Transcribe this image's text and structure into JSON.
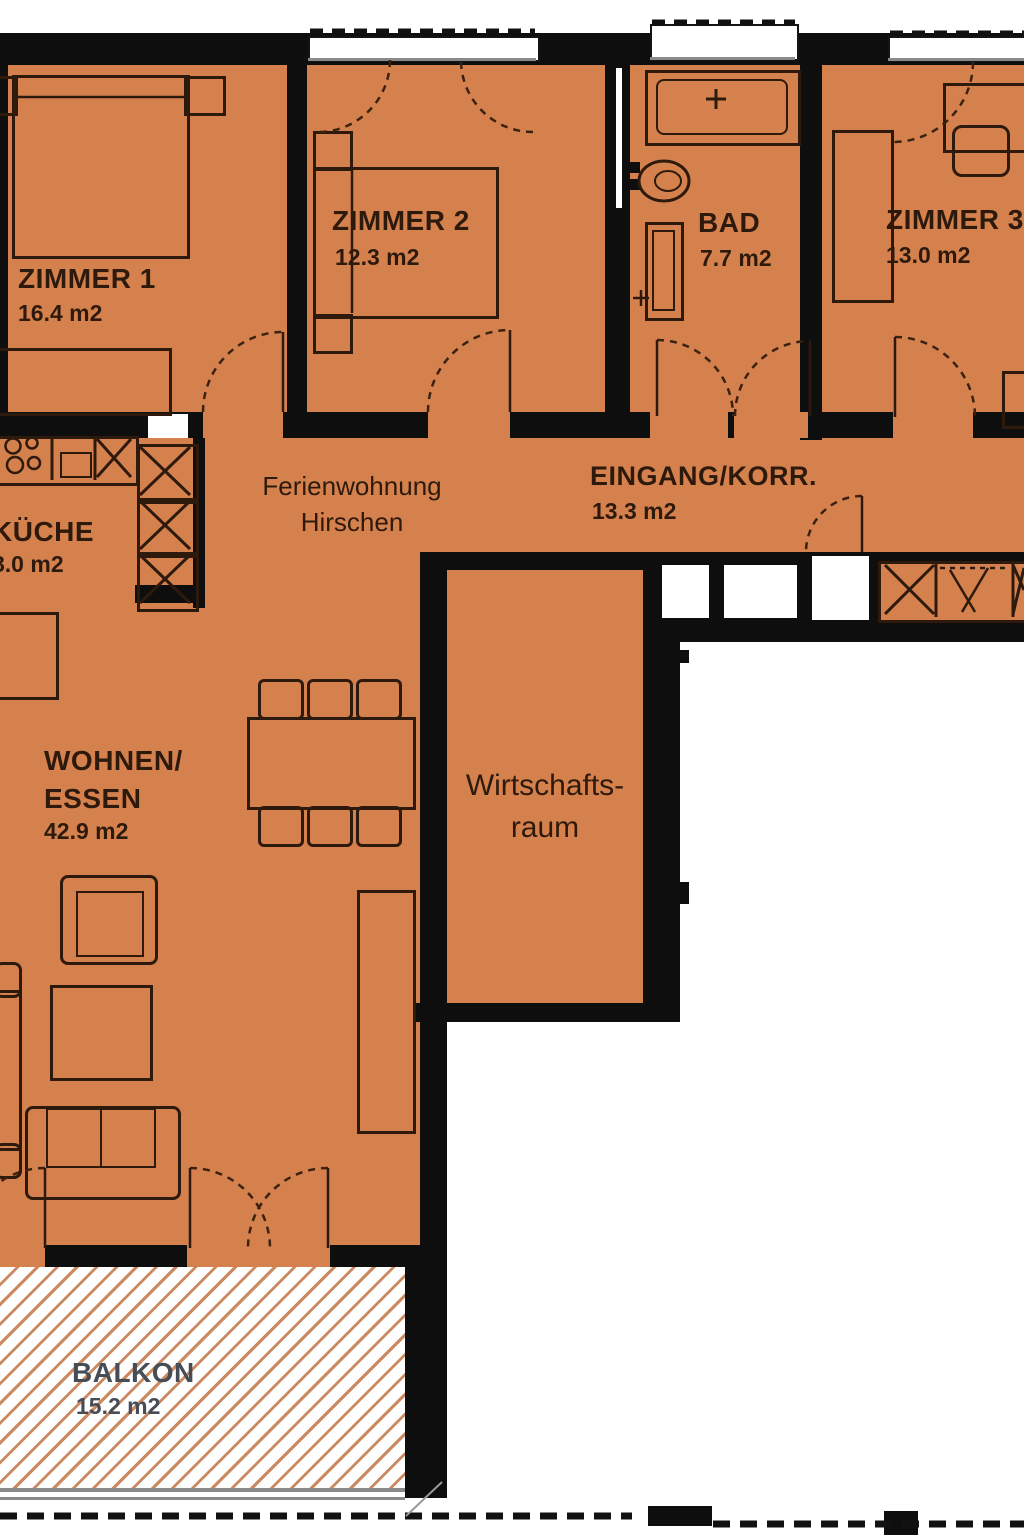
{
  "floorplan": {
    "title": {
      "line1": "Ferienwohnung",
      "line2": "Hirschen"
    },
    "rooms": {
      "zimmer1": {
        "name": "ZIMMER 1",
        "area": "16.4 m2"
      },
      "zimmer2": {
        "name": "ZIMMER 2",
        "area": "12.3 m2"
      },
      "bad": {
        "name": "BAD",
        "area": "7.7 m2"
      },
      "zimmer3": {
        "name": "ZIMMER 3",
        "area": "13.0 m2"
      },
      "kueche": {
        "name": "KÜCHE",
        "area": "8.0 m2"
      },
      "eingang": {
        "name": "EINGANG/KORR.",
        "area": "13.3 m2"
      },
      "wohnen": {
        "name_line1": "WOHNEN/",
        "name_line2": "ESSEN",
        "area": "42.9 m2"
      },
      "wirtschaftsraum": {
        "name_line1": "Wirtschafts-",
        "name_line2": "raum"
      },
      "balkon": {
        "name": "BALKON",
        "area": "15.2 m2"
      }
    },
    "colors": {
      "floor": "#d5814e",
      "wall": "#0e0e0e",
      "outline": "#2e1a0c",
      "hatch_line": "#cb8a60",
      "balkon_text": "#474d57"
    }
  }
}
